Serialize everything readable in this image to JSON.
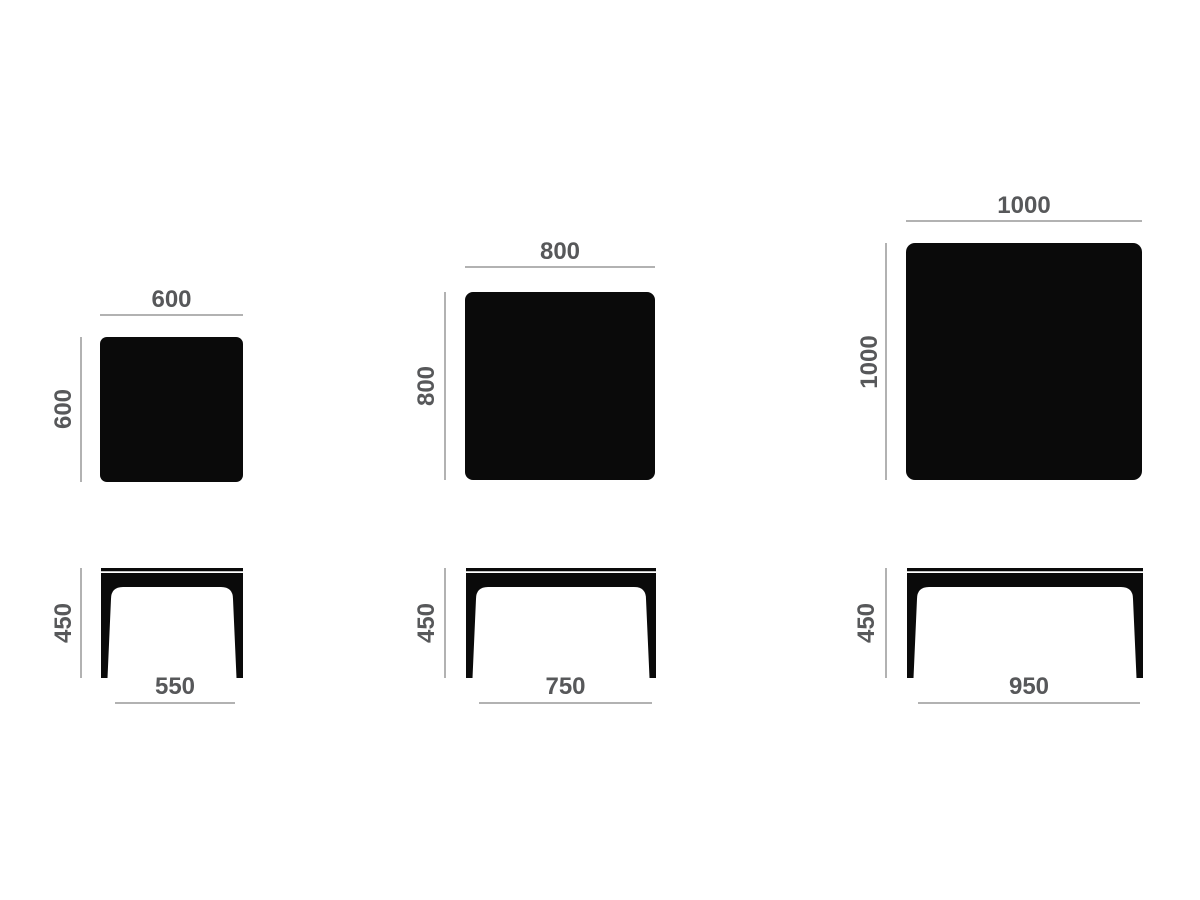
{
  "diagram": {
    "description": "Dimensional drawing of three square tables, top view and front elevation",
    "units": "mm"
  },
  "colors": {
    "shape": "#0a0a0a",
    "dimension_line": "#b2b2b2",
    "label": "#57585a",
    "background": "#ffffff"
  },
  "tables": [
    {
      "name": "table-600",
      "top_view": {
        "width_label": "600",
        "depth_label": "600"
      },
      "side_view": {
        "height_label": "450",
        "leg_span_label": "550"
      }
    },
    {
      "name": "table-800",
      "top_view": {
        "width_label": "800",
        "depth_label": "800"
      },
      "side_view": {
        "height_label": "450",
        "leg_span_label": "750"
      }
    },
    {
      "name": "table-1000",
      "top_view": {
        "width_label": "1000",
        "depth_label": "1000"
      },
      "side_view": {
        "height_label": "450",
        "leg_span_label": "950"
      }
    }
  ]
}
